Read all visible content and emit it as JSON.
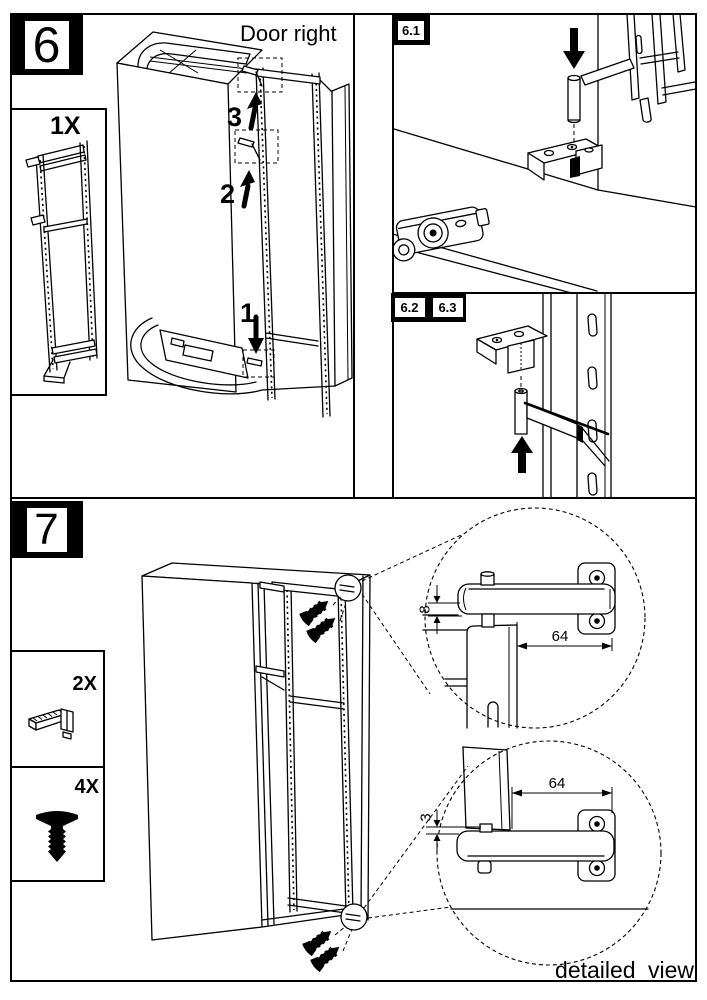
{
  "colors": {
    "ink": "#000000",
    "paper": "#ffffff"
  },
  "footer": {
    "label": "detailed view"
  },
  "step6": {
    "badge": "6",
    "door_side_label": "Door right",
    "parts": {
      "frame_qty": "1X"
    },
    "sequence": {
      "step1": "1",
      "step2": "2",
      "step3": "3"
    },
    "detail_labels": {
      "view61": "6.1",
      "view62": "6.2",
      "view63": "6.3"
    }
  },
  "step7": {
    "badge": "7",
    "parts": {
      "bracket_qty": "2X",
      "screw_qty": "4X"
    },
    "dimensions": {
      "top_detail": {
        "gap": "8",
        "offset": "64"
      },
      "bottom_detail": {
        "gap": "3",
        "offset": "64"
      }
    }
  }
}
